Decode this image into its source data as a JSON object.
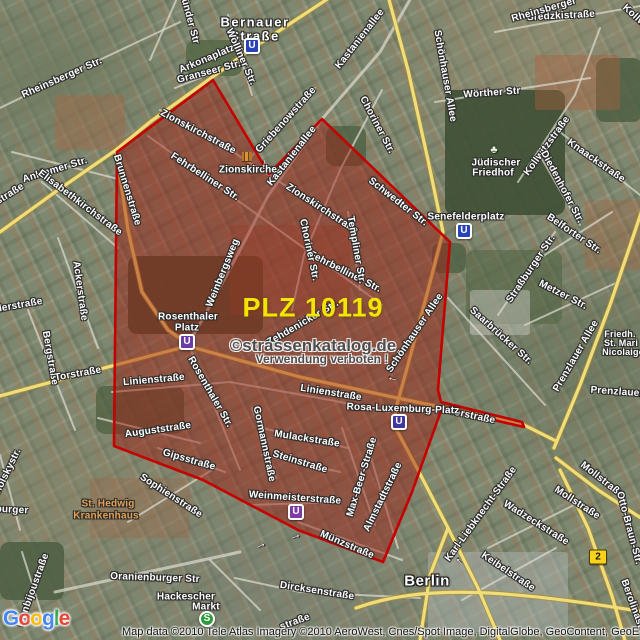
{
  "map": {
    "plz_label": "PLZ 10119",
    "watermark": {
      "line1": "©strassenkatalog.de",
      "line2": "Verwendung verboten !"
    },
    "attribution": "Map data ©2010 Tele Atlas  Imagery ©2010 AeroWest, Cnes/Spot Image, DigitalGlobe, GeoContent, GeoEye",
    "city_label": "Berlin",
    "logo": {
      "text": "Google",
      "letters": [
        {
          "ch": "G",
          "color": "#4285f4"
        },
        {
          "ch": "o",
          "color": "#ea4335"
        },
        {
          "ch": "o",
          "color": "#fbbc05"
        },
        {
          "ch": "g",
          "color": "#4285f4"
        },
        {
          "ch": "l",
          "color": "#34a853"
        },
        {
          "ch": "e",
          "color": "#ea4335"
        }
      ]
    },
    "boundary": {
      "name": "PLZ 10119 area",
      "stroke": "#c40000",
      "fill": "rgba(158,28,18,0.47)",
      "points": [
        [
          213,
          80
        ],
        [
          269,
          174
        ],
        [
          322,
          119
        ],
        [
          450,
          242
        ],
        [
          438,
          390
        ],
        [
          441,
          402
        ],
        [
          522,
          422
        ],
        [
          524,
          427
        ],
        [
          442,
          408
        ],
        [
          412,
          492
        ],
        [
          383,
          562
        ],
        [
          298,
          530
        ],
        [
          203,
          480
        ],
        [
          114,
          446
        ],
        [
          117,
          152
        ]
      ]
    },
    "arrow_glyph": "→",
    "labels": [
      {
        "t": "Bernauer",
        "x": 255,
        "y": 22,
        "r": 0,
        "k": "big"
      },
      {
        "t": "Straße",
        "x": 255,
        "y": 36,
        "r": 0,
        "k": "big"
      },
      {
        "t": "Rheinsberger Str.",
        "x": 62,
        "y": 78,
        "r": -24
      },
      {
        "t": "münder Str",
        "x": 189,
        "y": 17,
        "r": 75
      },
      {
        "t": "Arkonaplatz",
        "x": 207,
        "y": 59,
        "r": -23
      },
      {
        "t": "Wolliner Str.",
        "x": 241,
        "y": 57,
        "r": 66
      },
      {
        "t": "Granseer Str.",
        "x": 209,
        "y": 72,
        "r": -15
      },
      {
        "t": "Griebenowstraße",
        "x": 286,
        "y": 120,
        "r": -48
      },
      {
        "t": "Kastanienallee",
        "x": 360,
        "y": 39,
        "r": -52
      },
      {
        "t": "Kastanienallee",
        "x": 292,
        "y": 156,
        "r": -52
      },
      {
        "t": "Sredzkistraße",
        "x": 561,
        "y": 16,
        "r": -3
      },
      {
        "t": "Rheinsberger",
        "x": 544,
        "y": 10,
        "r": -16
      },
      {
        "t": "Schönhauser Allee",
        "x": 445,
        "y": 76,
        "r": 80
      },
      {
        "t": "Choriner Str.",
        "x": 377,
        "y": 125,
        "r": 62
      },
      {
        "t": "Wörther Str",
        "x": 492,
        "y": 93,
        "r": -4
      },
      {
        "t": "Kollwitzstraße",
        "x": 547,
        "y": 146,
        "r": -54
      },
      {
        "t": "Kollwitzstraße",
        "x": 650,
        "y": 30,
        "r": 42
      },
      {
        "t": "Knaackstraße",
        "x": 596,
        "y": 161,
        "r": 35
      },
      {
        "t": "Diedenhofer Str.",
        "x": 562,
        "y": 187,
        "r": 62
      },
      {
        "t": "Jüdischer",
        "x": 496,
        "y": 163,
        "r": 0
      },
      {
        "t": "Friedhof",
        "x": 493,
        "y": 173,
        "r": 0
      },
      {
        "t": "Zionskirchstraße",
        "x": 198,
        "y": 132,
        "r": 28
      },
      {
        "t": "Zionskirchstraße",
        "x": 322,
        "y": 209,
        "r": 33
      },
      {
        "t": "Fehrbelliner Str.",
        "x": 205,
        "y": 177,
        "r": 33
      },
      {
        "t": "Fehrbelliner Str.",
        "x": 345,
        "y": 272,
        "r": 27
      },
      {
        "t": "Schwedter Str.",
        "x": 398,
        "y": 202,
        "r": 38
      },
      {
        "t": "Templiner Str.",
        "x": 356,
        "y": 250,
        "r": 80
      },
      {
        "t": "Choriner Str.",
        "x": 309,
        "y": 250,
        "r": 78
      },
      {
        "t": "Zionskirche",
        "x": 248,
        "y": 170,
        "r": 0
      },
      {
        "t": "Brunnenstraße",
        "x": 127,
        "y": 190,
        "r": 73
      },
      {
        "t": "Anklamer Str.",
        "x": 55,
        "y": 170,
        "r": -17
      },
      {
        "t": "straße",
        "x": 10,
        "y": 194,
        "r": -32
      },
      {
        "t": "Elisabethkirchstraße",
        "x": 80,
        "y": 203,
        "r": 37
      },
      {
        "t": "Ackerstraße",
        "x": 80,
        "y": 291,
        "r": 82
      },
      {
        "t": "Bergstraße",
        "x": 50,
        "y": 358,
        "r": 80
      },
      {
        "t": "oderstraße",
        "x": 16,
        "y": 306,
        "r": -10
      },
      {
        "t": "Weinbergsweg",
        "x": 223,
        "y": 273,
        "r": -68
      },
      {
        "t": "Rosenthaler Str.",
        "x": 210,
        "y": 392,
        "r": 60
      },
      {
        "t": "Zehdenicker Str.",
        "x": 303,
        "y": 323,
        "r": -30
      },
      {
        "t": "Schönhauser Allee",
        "x": 415,
        "y": 333,
        "r": -56
      },
      {
        "t": "Torstraße",
        "x": 78,
        "y": 374,
        "r": -10
      },
      {
        "t": "Torstraße",
        "x": 472,
        "y": 416,
        "r": 12
      },
      {
        "t": "Linienstraße",
        "x": 154,
        "y": 380,
        "r": -5
      },
      {
        "t": "Linienstraße",
        "x": 331,
        "y": 393,
        "r": 9
      },
      {
        "t": "Auguststraße",
        "x": 158,
        "y": 430,
        "r": -8
      },
      {
        "t": "Gipsstraße",
        "x": 189,
        "y": 460,
        "r": 16
      },
      {
        "t": "Sophienstraße",
        "x": 171,
        "y": 496,
        "r": 33
      },
      {
        "t": "Gormannstraße",
        "x": 264,
        "y": 444,
        "r": 78
      },
      {
        "t": "Mulackstraße",
        "x": 307,
        "y": 439,
        "r": 9
      },
      {
        "t": "Steinstraße",
        "x": 300,
        "y": 462,
        "r": 17
      },
      {
        "t": "Weinmeisterstraße",
        "x": 295,
        "y": 498,
        "r": 4
      },
      {
        "t": "Max-Beer-Straße",
        "x": 362,
        "y": 477,
        "r": -73
      },
      {
        "t": "Almstadtstraße",
        "x": 383,
        "y": 497,
        "r": -64
      },
      {
        "t": "Münzstraße",
        "x": 347,
        "y": 545,
        "r": 23
      },
      {
        "t": "Rosa-Luxemburg-Platz",
        "x": 403,
        "y": 409,
        "r": 2
      },
      {
        "t": "Senefelderplatz",
        "x": 466,
        "y": 217,
        "r": 0
      },
      {
        "t": "Belforter Str.",
        "x": 574,
        "y": 234,
        "r": 34
      },
      {
        "t": "Straßburger Str.",
        "x": 531,
        "y": 269,
        "r": -56
      },
      {
        "t": "Metzer Str.",
        "x": 563,
        "y": 295,
        "r": 27
      },
      {
        "t": "Saarbrücker Str.",
        "x": 501,
        "y": 336,
        "r": 42
      },
      {
        "t": "Prenzlauer Allee",
        "x": 576,
        "y": 356,
        "r": -60
      },
      {
        "t": "Prenzlauer",
        "x": 617,
        "y": 392,
        "r": 4
      },
      {
        "t": "Friedh.",
        "x": 620,
        "y": 334,
        "r": 0,
        "k": "sm"
      },
      {
        "t": "St. Mari",
        "x": 621,
        "y": 343,
        "r": 0,
        "k": "sm"
      },
      {
        "t": "Nicolaige",
        "x": 623,
        "y": 352,
        "r": 0,
        "k": "sm"
      },
      {
        "t": "Mollstraße",
        "x": 602,
        "y": 480,
        "r": 38
      },
      {
        "t": "Mollstraße",
        "x": 577,
        "y": 503,
        "r": 33
      },
      {
        "t": "Karl-Liebknecht-Straße",
        "x": 481,
        "y": 514,
        "r": -54
      },
      {
        "t": "Wadzeckstraße",
        "x": 536,
        "y": 523,
        "r": 32
      },
      {
        "t": "Keibelstraße",
        "x": 508,
        "y": 572,
        "r": 34
      },
      {
        "t": "Otto-Braun-Str.",
        "x": 629,
        "y": 528,
        "r": 75
      },
      {
        "t": "Berolinastraße",
        "x": 636,
        "y": 614,
        "r": 70
      },
      {
        "t": "Dircksenstraße",
        "x": 317,
        "y": 591,
        "r": 9
      },
      {
        "t": "straße",
        "x": 295,
        "y": 622,
        "r": -20
      },
      {
        "t": "Oranienburger Str",
        "x": 155,
        "y": 578,
        "r": 2
      },
      {
        "t": "Monbijoustraße",
        "x": 33,
        "y": 590,
        "r": -70
      },
      {
        "t": "Tucholskystr.",
        "x": 4,
        "y": 479,
        "r": -64
      },
      {
        "t": "burger",
        "x": 12,
        "y": 510,
        "r": 3
      },
      {
        "t": "Hackescher",
        "x": 186,
        "y": 597,
        "r": 0
      },
      {
        "t": "Markt",
        "x": 206,
        "y": 607,
        "r": 0
      },
      {
        "t": "Rosenthaler",
        "x": 188,
        "y": 317,
        "r": 0
      },
      {
        "t": "Platz",
        "x": 187,
        "y": 328,
        "r": 0
      },
      {
        "t": "St. Hedwig",
        "x": 108,
        "y": 504,
        "r": 0,
        "k": "poi"
      },
      {
        "t": "Krankenhaus",
        "x": 106,
        "y": 516,
        "r": 0,
        "k": "poi"
      },
      {
        "t": "Berlin",
        "x": 427,
        "y": 581,
        "r": 0,
        "k": "city",
        "n": "city-label"
      }
    ],
    "stations": [
      {
        "type": "U",
        "name": "Bernauer Straße",
        "x": 252,
        "y": 46,
        "bg": "#2843b8"
      },
      {
        "type": "U",
        "name": "Senefelderplatz",
        "x": 464,
        "y": 231,
        "bg": "#2843b8"
      },
      {
        "type": "U",
        "name": "Rosenthaler Platz",
        "x": 187,
        "y": 342,
        "bg": "#6b3ba6"
      },
      {
        "type": "U",
        "name": "Weinmeisterstraße",
        "x": 296,
        "y": 512,
        "bg": "#7d3ba6"
      },
      {
        "type": "U",
        "name": "Rosa-Luxemburg-Platz",
        "x": 399,
        "y": 422,
        "bg": "#41379e"
      },
      {
        "type": "S",
        "name": "Hackescher Markt",
        "x": 207,
        "y": 619,
        "bg": "#2e9b3f"
      }
    ],
    "shields": [
      {
        "text": "2",
        "x": 598,
        "y": 557
      }
    ],
    "arrows": [
      {
        "x": 266,
        "y": 164,
        "r": 100
      },
      {
        "x": 260,
        "y": 544,
        "r": -25
      },
      {
        "x": 295,
        "y": 535,
        "r": -20
      },
      {
        "x": 392,
        "y": 381,
        "r": 195
      },
      {
        "x": 458,
        "y": 563,
        "r": -130
      }
    ],
    "icons": [
      {
        "kind": "church",
        "x": 247,
        "y": 157
      },
      {
        "kind": "cemetery",
        "x": 494,
        "y": 150,
        "glyph": "♣"
      }
    ]
  }
}
